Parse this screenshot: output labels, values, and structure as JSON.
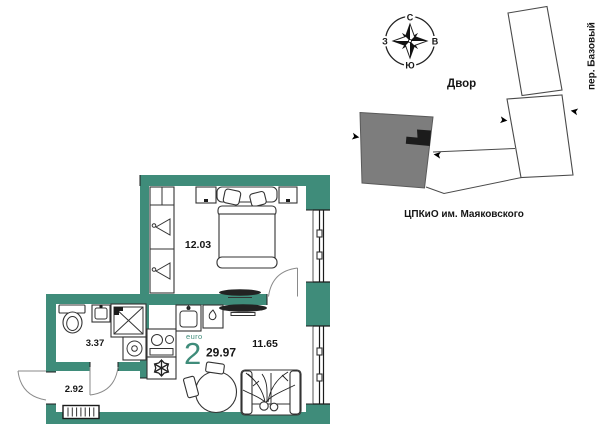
{
  "apartment": {
    "type_label": "euro",
    "type_number": "2",
    "total_area": "29.97",
    "rooms": {
      "bedroom": "12.03",
      "living": "11.65",
      "bathroom": "3.37",
      "hall": "2.92"
    }
  },
  "site_plan": {
    "courtyard_label": "Двор",
    "street_label": "пер. Базовый",
    "park_label": "ЦПКиО им. Маяковского",
    "compass": {
      "north": "С",
      "east": "В",
      "south": "Ю",
      "west": "З"
    }
  },
  "colors": {
    "wall_teal": "#3F8C7A",
    "subject_building_gray": "#7D7D7D",
    "marker_black": "#111111",
    "line_dark": "#3C3C3C"
  }
}
